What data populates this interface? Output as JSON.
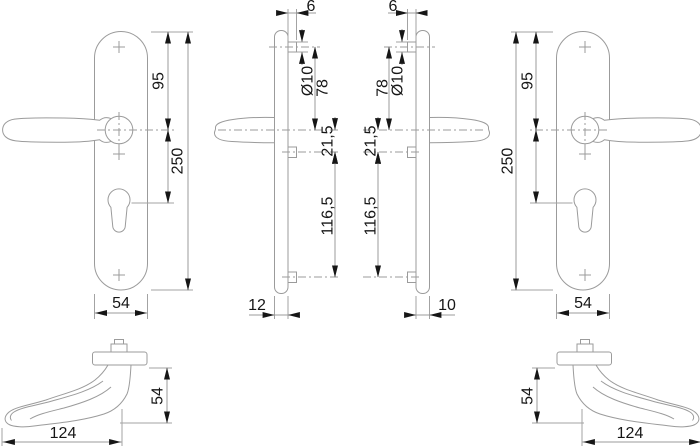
{
  "drawing": {
    "kind": "lever-handle-on-backplate dimensional drawing",
    "views": {
      "front_left": {
        "dims": {
          "top_to_handle": "95",
          "height": "250",
          "width": "54"
        }
      },
      "side_left": {
        "dims": {
          "lug_offset": "6",
          "lug_diameter": "Ø10",
          "top_lug_to_handle": "78",
          "handle_to_mid_lug": "21,5",
          "mid_to_bottom_lug": "116,5",
          "depth": "12"
        }
      },
      "side_right": {
        "dims": {
          "lug_offset": "6",
          "lug_diameter": "Ø10",
          "top_lug_to_handle": "78",
          "handle_to_mid_lug": "21,5",
          "mid_to_bottom_lug": "116,5",
          "depth": "10"
        }
      },
      "front_right": {
        "dims": {
          "top_to_handle": "95",
          "height": "250",
          "width": "54"
        }
      },
      "top_left": {
        "dims": {
          "length": "124",
          "projection": "54"
        }
      },
      "top_right": {
        "dims": {
          "length": "124",
          "projection": "54"
        }
      }
    },
    "colors": {
      "line": "#9b9b9b",
      "ink": "#161616",
      "background": "#ffffff"
    }
  }
}
